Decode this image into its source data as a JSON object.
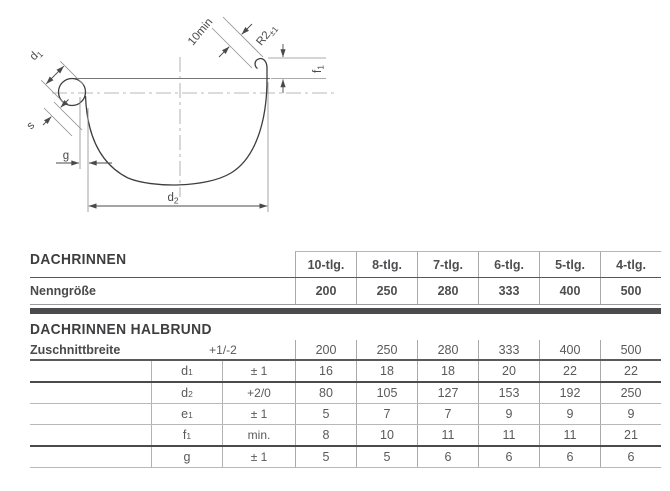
{
  "diagram": {
    "labels": {
      "d1_base": "d",
      "d1_sub": "1",
      "s": "s",
      "g": "g",
      "d2_base": "d",
      "d2_sub": "2",
      "overlap": "10min",
      "radius_base": "R2",
      "radius_sub": "±1",
      "f1_base": "f",
      "f1_sub": "1"
    }
  },
  "table": {
    "section1_title": "DACHRINNEN",
    "section2_title": "DACHRINNEN HALBRUND",
    "columns": [
      "10-tlg.",
      "8-tlg.",
      "7-tlg.",
      "6-tlg.",
      "5-tlg.",
      "4-tlg."
    ],
    "nenngroesse": {
      "label": "Nenngröße",
      "values": [
        "200",
        "250",
        "280",
        "333",
        "400",
        "500"
      ]
    },
    "rows": [
      {
        "label": "Zuschnittbreite",
        "sym": "",
        "sub": "",
        "tol": "+1/-2",
        "values": [
          "200",
          "250",
          "280",
          "333",
          "400",
          "500"
        ]
      },
      {
        "label": "",
        "sym": "d",
        "sub": "1",
        "tol": "± 1",
        "values": [
          "16",
          "18",
          "18",
          "20",
          "22",
          "22"
        ]
      },
      {
        "label": "",
        "sym": "d",
        "sub": "2",
        "tol": "+2/0",
        "values": [
          "80",
          "105",
          "127",
          "153",
          "192",
          "250"
        ]
      },
      {
        "label": "",
        "sym": "e",
        "sub": "1",
        "tol": "± 1",
        "values": [
          "5",
          "7",
          "7",
          "9",
          "9",
          "9"
        ]
      },
      {
        "label": "",
        "sym": "f",
        "sub": "1",
        "tol": "min.",
        "values": [
          "8",
          "10",
          "11",
          "11",
          "11",
          "21"
        ]
      },
      {
        "label": "",
        "sym": "g",
        "sub": "",
        "tol": "± 1",
        "values": [
          "5",
          "5",
          "6",
          "6",
          "6",
          "6"
        ]
      }
    ]
  },
  "colors": {
    "heading": "#3e3e40",
    "text": "#59595b",
    "bar": "#4b4b4e",
    "line": "#aaaaac"
  }
}
